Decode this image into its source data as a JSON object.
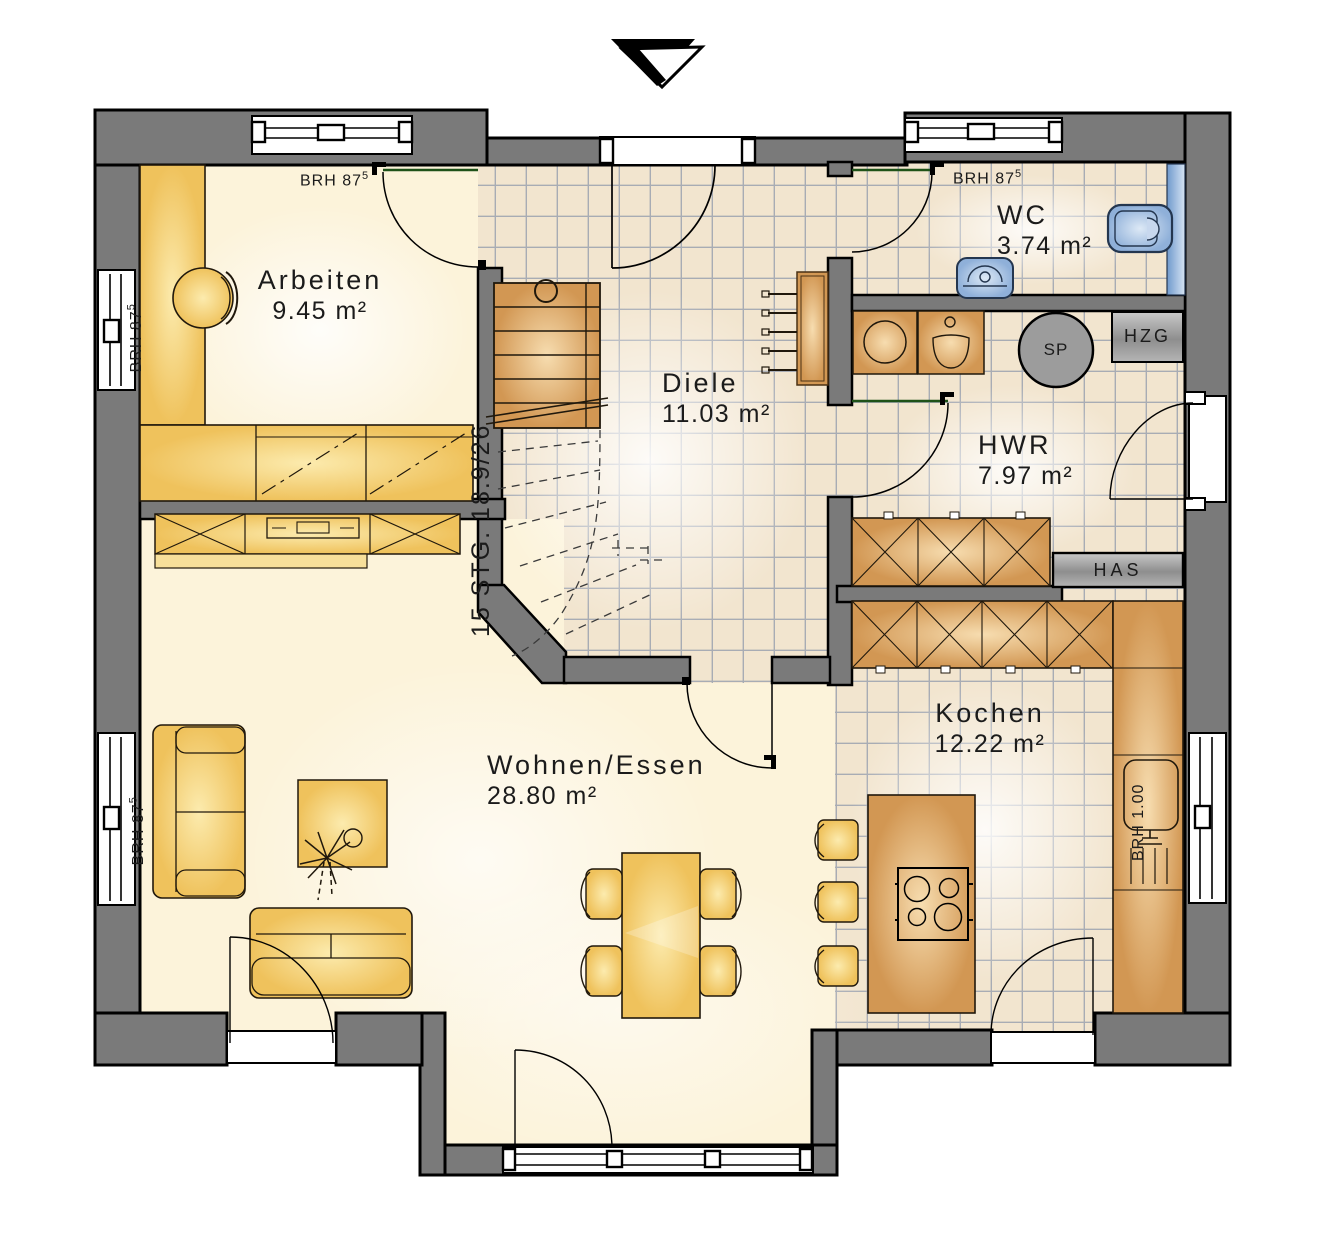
{
  "plan": {
    "rooms": {
      "arbeiten": {
        "name": "Arbeiten",
        "area": "9.45 m²"
      },
      "diele": {
        "name": "Diele",
        "area": "11.03 m²"
      },
      "wc": {
        "name": "WC",
        "area": "3.74 m²"
      },
      "hwr": {
        "name": "HWR",
        "area": "7.97 m²"
      },
      "kochen": {
        "name": "Kochen",
        "area": "12.22 m²"
      },
      "wohnen_essen": {
        "name": "Wohnen/Essen",
        "area": "28.80 m²"
      }
    },
    "labels": {
      "brh87": "BRH 87",
      "brh87_sup": "5",
      "brh100": "BRH 1.00",
      "stairs": "15 STG. 18.9/26",
      "hzg": "HZG",
      "has": "HAS",
      "sp": "SP"
    },
    "colors": {
      "wall": "#7a7a7a",
      "tile_floor": "#f2e5cf",
      "tile_line": "#a8acb4",
      "cream_floor": "#fcf3da",
      "furniture_gold": "#f0c763",
      "cabinet_tan": "#dca566",
      "sanitary_blue": "#a9c3e4",
      "door_leaf_green": "#1e5218",
      "utility_gray": "#9c9c9c"
    }
  }
}
